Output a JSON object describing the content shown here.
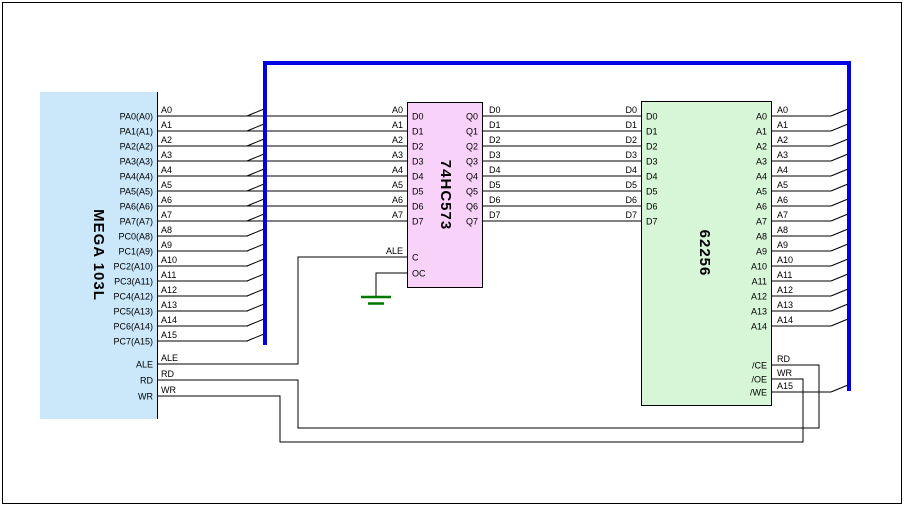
{
  "page": {
    "background": "#ffffff",
    "border_color": "#000000"
  },
  "colors": {
    "bus": "#0000e6",
    "wire": "#000000",
    "ground": "#007700",
    "text": "#000000",
    "mcu_fill": "#cbe8fb",
    "latch_fill": "#f9d2f9",
    "sram_fill": "#d7f5d7"
  },
  "mcu": {
    "name": "MEGA 103L",
    "pins": [
      "PA0(A0)",
      "PA1(A1)",
      "PA2(A2)",
      "PA3(A3)",
      "PA4(A4)",
      "PA5(A5)",
      "PA6(A6)",
      "PA7(A7)",
      "PC0(A8)",
      "PC1(A9)",
      "PC2(A10)",
      "PC3(A11)",
      "PC4(A12)",
      "PC5(A13)",
      "PC6(A14)",
      "PC7(A15)",
      "ALE",
      "RD",
      "WR"
    ]
  },
  "latch": {
    "name": "74HC573",
    "pins_left": [
      "D0",
      "D1",
      "D2",
      "D3",
      "D4",
      "D5",
      "D6",
      "D7"
    ],
    "pins_right": [
      "Q0",
      "Q1",
      "Q2",
      "Q3",
      "Q4",
      "Q5",
      "Q6",
      "Q7"
    ],
    "pin_latch_enable": "C",
    "pin_output_enable": "OC"
  },
  "sram": {
    "name": "62256",
    "pins_left": [
      "D0",
      "D1",
      "D2",
      "D3",
      "D4",
      "D5",
      "D6",
      "D7"
    ],
    "pins_addr": [
      "A0",
      "A1",
      "A2",
      "A3",
      "A4",
      "A5",
      "A6",
      "A7",
      "A8",
      "A9",
      "A10",
      "A11",
      "A12",
      "A13",
      "A14"
    ],
    "pins_ctrl": [
      "/CE",
      "/OE",
      "/WE"
    ]
  },
  "nets": {
    "addr": [
      "A0",
      "A1",
      "A2",
      "A3",
      "A4",
      "A5",
      "A6",
      "A7",
      "A8",
      "A9",
      "A10",
      "A11",
      "A12",
      "A13",
      "A14",
      "A15"
    ],
    "mcu_ctrl": [
      "ALE",
      "RD",
      "WR"
    ],
    "data": [
      "D0",
      "D1",
      "D2",
      "D3",
      "D4",
      "D5",
      "D6",
      "D7"
    ],
    "sram_addr": [
      "A0",
      "A1",
      "A2",
      "A3",
      "A4",
      "A5",
      "A6",
      "A7",
      "A8",
      "A9",
      "A10",
      "A11",
      "A12",
      "A13",
      "A14"
    ],
    "sram_ctrl": [
      "RD",
      "WR",
      "A15"
    ]
  }
}
